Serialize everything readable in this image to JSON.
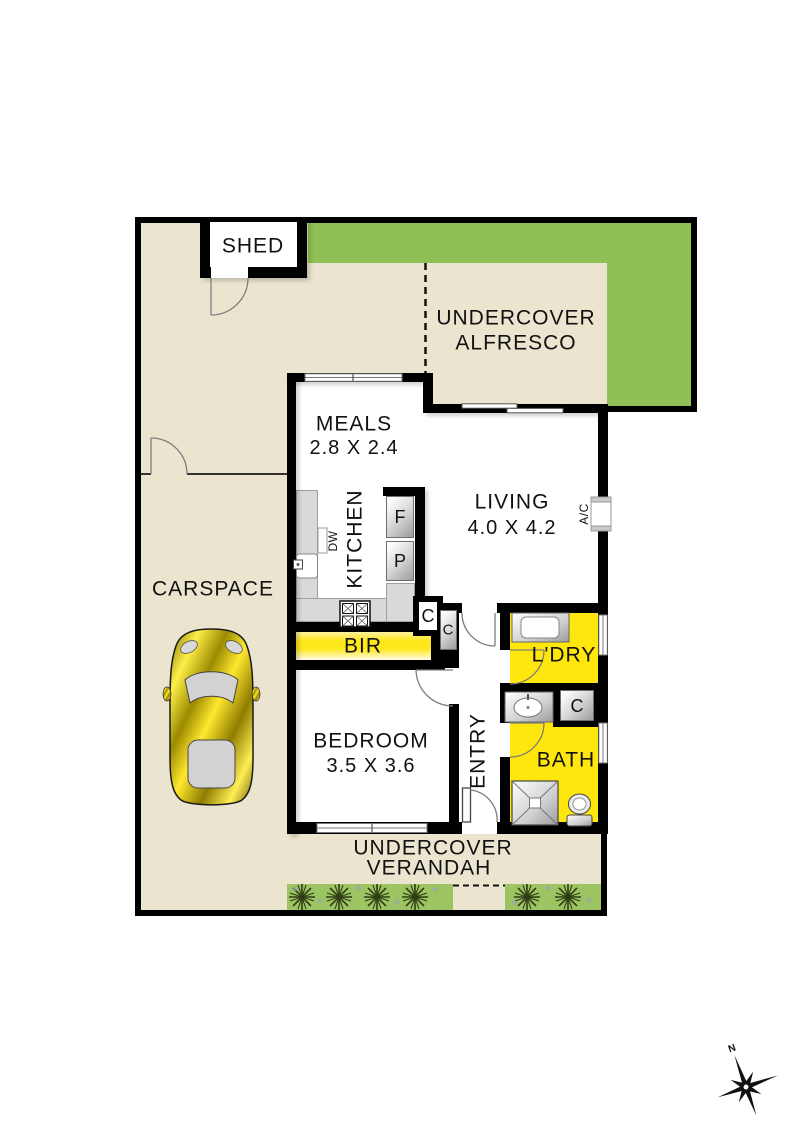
{
  "colors": {
    "floor_beige": "#ebe5d0",
    "grass_green": "#90bf55",
    "garden_green": "#9cc463",
    "wet_yellow": "#ffe60d",
    "bench_grey": "#d9d9d9",
    "wall_black": "#000000"
  },
  "labels": {
    "shed": "SHED",
    "alfresco_line1": "UNDERCOVER",
    "alfresco_line2": "ALFRESCO",
    "meals": "MEALS",
    "meals_dims": "2.8 X 2.4",
    "living": "LIVING",
    "living_dims": "4.0 X 4.2",
    "kitchen": "KITCHEN",
    "dishwasher": "DW",
    "fridge": "F",
    "pantry": "P",
    "air_conditioner": "A/C",
    "cupboard1": "C",
    "cupboard2": "C",
    "cupboard3": "C",
    "bir": "BIR",
    "bedroom": "BEDROOM",
    "bedroom_dims": "3.5 X 3.6",
    "entry": "ENTRY",
    "laundry": "L'DRY",
    "bath": "BATH",
    "carspace": "CARSPACE",
    "verandah_line1": "UNDERCOVER",
    "verandah_line2": "VERANDAH",
    "north": "N"
  }
}
